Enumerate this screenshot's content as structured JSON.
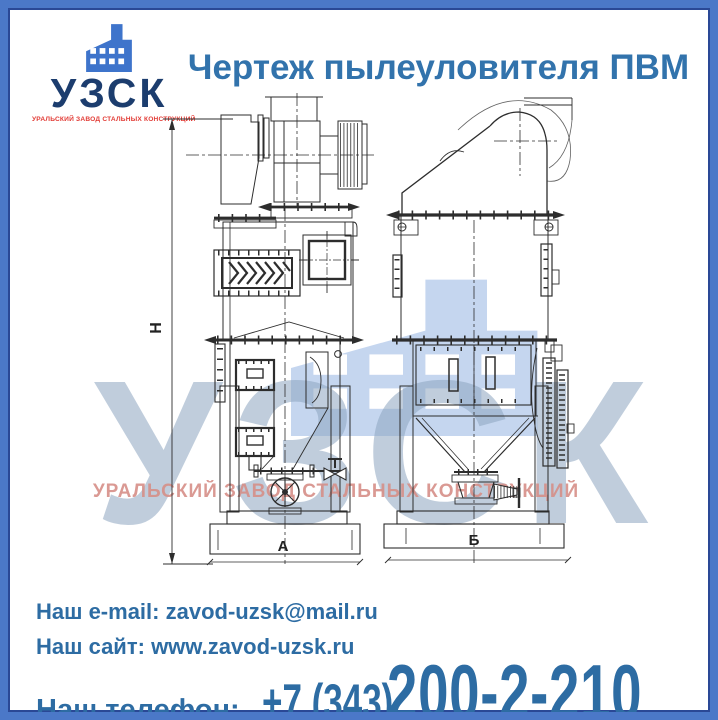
{
  "logo": {
    "acronym": "УЗСК",
    "tagline": "УРАЛЬСКИЙ ЗАВОД СТАЛЬНЫХ КОНСТРУКЦИЙ"
  },
  "header": {
    "title": "Чертеж пылеуловителя ПВМ"
  },
  "drawing": {
    "dim_height_label": "Н",
    "dim_width_front_label": "А",
    "dim_width_side_label": "Б"
  },
  "watermark": {
    "acronym": "УЗСК",
    "tagline": "УРАЛЬСКИЙ ЗАВОД СТАЛЬНЫХ КОНСТРУКЦИЙ"
  },
  "contacts": {
    "email_label": "Наш e-mail:",
    "email_value": "zavod-uzsk@mail.ru",
    "site_label": "Наш сайт:",
    "site_value": "www.zavod-uzsk.ru",
    "phone_label": "Наш телефон:",
    "phone_prefix": "+7 (343)",
    "phone_number": "200-2-210"
  },
  "colors": {
    "frame_blue": "#4b78c8",
    "frame_inner_navy": "#2a4896",
    "logo_icon_blue": "#3e74cb",
    "logo_navy": "#1c3d6e",
    "logo_red": "#e23b35",
    "title_blue": "#3273ac",
    "contact_blue": "#2d6ca3",
    "watermark_icon_blue": "#c2d4ef",
    "watermark_text_blue": "#8ea6c0",
    "watermark_text_red": "#d68f88",
    "drawing_stroke": "#2d2d2d"
  }
}
